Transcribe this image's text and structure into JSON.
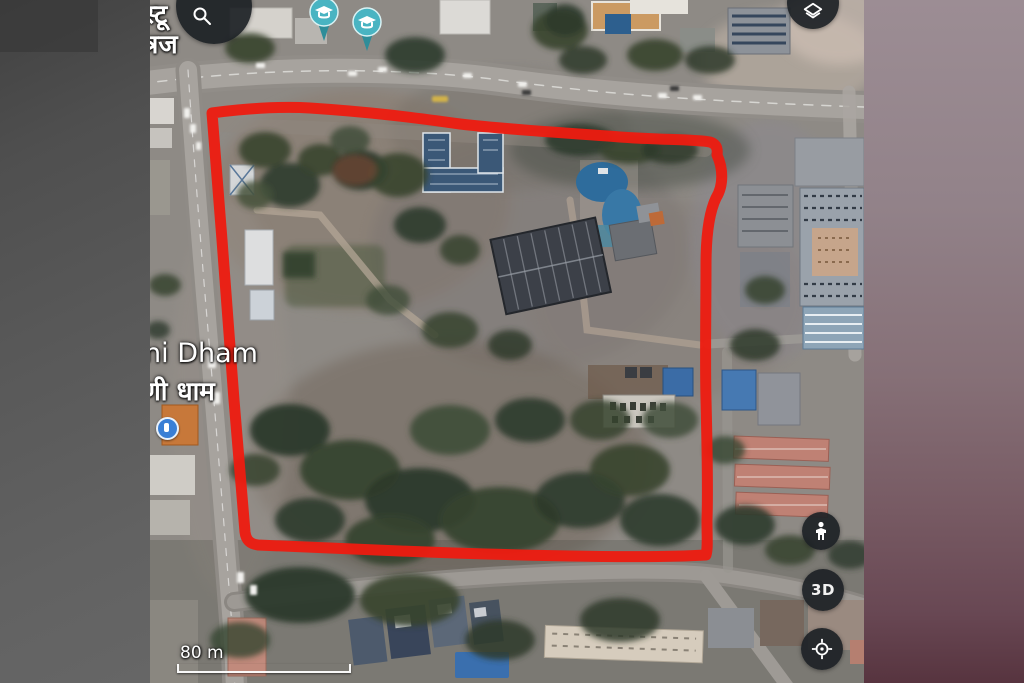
{
  "map": {
    "partial_label_top_left": {
      "line1": "स्टू",
      "line2": "त्रज"
    },
    "place_label": {
      "latin": "ni Dham",
      "hindi": "णी धाम"
    },
    "scale_bar": {
      "distance": "80 m"
    },
    "controls": {
      "search": "search-icon",
      "layers": "layers-icon",
      "pegman": "pegman-icon",
      "three_d_label": "3D",
      "my_location": "my-location-icon"
    },
    "markers": {
      "school_pin_count": 2,
      "place_dot": "blue-place-marker"
    },
    "annotation": {
      "type": "hand-drawn-boundary",
      "color": "#ee1b10"
    },
    "palette": {
      "pin_teal": "#49b4c2",
      "road_gray": "#a7a39e",
      "tree_green": "#36432f"
    }
  }
}
